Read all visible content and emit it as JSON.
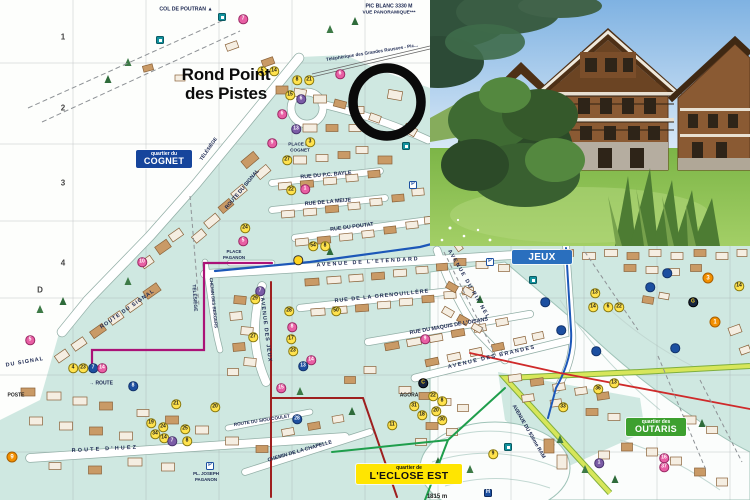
{
  "title": {
    "line1": "Rond Point",
    "line2": "des Pistes"
  },
  "quartiers": {
    "cognet": {
      "small": "quartier du",
      "name": "COGNET",
      "bg": "#16459c",
      "fg": "#ffffff"
    },
    "jeux": {
      "small": "",
      "name": "JEUX",
      "bg": "#2a6fbe",
      "fg": "#ffffff"
    },
    "outaris": {
      "small": "quartier des",
      "name": "OUTARIS",
      "bg": "#3da02f",
      "fg": "#ffffff"
    },
    "eclose": {
      "small": "quartier de",
      "name": "L'ECLOSE EST",
      "bg": "#ffe501",
      "fg": "#111111"
    }
  },
  "annotation": {
    "shape": "circle",
    "x": 387,
    "y": 102,
    "r": 34,
    "color": "#0a0a0a"
  },
  "palette": {
    "zone_teal": "#cfe8e1",
    "badge_yellow": "#ffe24d",
    "badge_pink": "#e85fa4",
    "badge_purple": "#7b5ca6",
    "badge_blue": "#1c4fa0",
    "badge_orange": "#f39000",
    "teal_square": "#12929e",
    "route_blue": "#1c57b8",
    "route_magenta": "#aa1277",
    "route_green": "#1f9e4c",
    "route_red": "#cf2a2a",
    "boundary_dark_red": "#9e1f1f",
    "ram_road": "#d7e65a"
  },
  "map": {
    "grid": [
      {
        "t": "1",
        "x": 63,
        "y": 37
      },
      {
        "t": "2",
        "x": 63,
        "y": 108
      },
      {
        "t": "3",
        "x": 63,
        "y": 183
      },
      {
        "t": "4",
        "x": 63,
        "y": 263
      },
      {
        "t": "D",
        "x": 40,
        "y": 290
      }
    ],
    "labels": [
      {
        "t": "COL DE POUTRAN ▲",
        "x": 186,
        "y": 10,
        "s": 5.2
      },
      {
        "t": "PIC BLANC 3330 M",
        "x": 389,
        "y": 7,
        "s": 5.2
      },
      {
        "t": "VUE PANORAMIQUE***",
        "x": 389,
        "y": 14,
        "s": 4.8
      },
      {
        "t": "Téléphérique des Grandes Rousses - Pic...",
        "x": 372,
        "y": 53,
        "r": -9,
        "s": 4.6
      },
      {
        "t": "PLACE DU",
        "x": 300,
        "y": 145,
        "s": 4.6
      },
      {
        "t": "COGNET",
        "x": 300,
        "y": 151,
        "s": 4.6
      },
      {
        "t": "TÉLÉSIÈGE",
        "x": 210,
        "y": 150,
        "r": -55,
        "s": 4.8
      },
      {
        "t": "ROUTE DU SIGNAL",
        "x": 243,
        "y": 190,
        "r": -50,
        "s": 5.4
      },
      {
        "t": "RUE DU P.C. BAYLE",
        "x": 326,
        "y": 176,
        "r": -5,
        "s": 5.4
      },
      {
        "t": "RUE DE LA MEIJE",
        "x": 328,
        "y": 203,
        "r": -5,
        "s": 5.4
      },
      {
        "t": "RUE DU POUTAT",
        "x": 352,
        "y": 228,
        "r": -7,
        "s": 5.4
      },
      {
        "t": "AVENUE DE L'ETENDARD",
        "x": 368,
        "y": 263,
        "r": -3.5,
        "s": 5.4,
        "ls": 1.8
      },
      {
        "t": "RUE DE LA GRENOUILLÈRE",
        "x": 382,
        "y": 297,
        "r": -6,
        "s": 5.4,
        "ls": 1
      },
      {
        "t": "RUE DU MAQUIS DE L'OISANS",
        "x": 449,
        "y": 327,
        "r": -10,
        "s": 5.4
      },
      {
        "t": "AVENUE DES BRANDES",
        "x": 492,
        "y": 358,
        "r": -13,
        "s": 5.4,
        "ls": 1.5
      },
      {
        "t": "AVENUE DU RIF NEL",
        "x": 468,
        "y": 285,
        "r": 60,
        "s": 5.4,
        "ls": 1.5
      },
      {
        "t": "AVENUE DES JEUX",
        "x": 265,
        "y": 330,
        "r": 83,
        "s": 5.4,
        "ls": 1
      },
      {
        "t": "ROUTE DU SIGNAL",
        "x": 128,
        "y": 310,
        "r": -35,
        "s": 5.4,
        "ls": 1
      },
      {
        "t": "DU SIGNAL",
        "x": 25,
        "y": 363,
        "r": -10,
        "s": 5.4,
        "ls": 1
      },
      {
        "t": "TÉLÉSIÈGE",
        "x": 193,
        "y": 298,
        "r": 86,
        "s": 4.8
      },
      {
        "t": "CHEMIN DES BERGERS",
        "x": 213,
        "y": 303,
        "r": 84,
        "s": 4.4
      },
      {
        "t": "PLACE",
        "x": 234,
        "y": 252,
        "s": 4.4
      },
      {
        "t": "PAGANON",
        "x": 234,
        "y": 258,
        "s": 4.4
      },
      {
        "t": "POSTE",
        "x": 16,
        "y": 396,
        "s": 5,
        "c": "#222222"
      },
      {
        "t": "→  ROUTE",
        "x": 101,
        "y": 384,
        "s": 5
      },
      {
        "t": "ROUTE  D'HUEZ",
        "x": 105,
        "y": 450,
        "r": -3,
        "s": 5.4,
        "ls": 2.2
      },
      {
        "t": "ROUTE DU SIOU COULET",
        "x": 262,
        "y": 421,
        "r": -9,
        "s": 4.6
      },
      {
        "t": "CHEMIN DE LA CHAPELLE",
        "x": 300,
        "y": 452,
        "r": -16,
        "s": 5.2
      },
      {
        "t": "PL. JOSEPH",
        "x": 206,
        "y": 474,
        "s": 4.4
      },
      {
        "t": "PAGANON",
        "x": 206,
        "y": 480,
        "s": 4.4
      },
      {
        "t": "AGORA",
        "x": 409,
        "y": 396,
        "s": 5,
        "c": "#222222"
      },
      {
        "t": "AVENUE DU 93ème RAM",
        "x": 528,
        "y": 432,
        "r": 60,
        "s": 5.2
      },
      {
        "t": "1815 m",
        "x": 437,
        "y": 497,
        "s": 6,
        "c": "#222222"
      }
    ],
    "badges": [
      {
        "n": "7",
        "x": 243,
        "y": 19,
        "c": "p"
      },
      {
        "n": "",
        "x": 222,
        "y": 17,
        "c": "t"
      },
      {
        "n": "",
        "x": 160,
        "y": 40,
        "c": "t"
      },
      {
        "n": "5",
        "x": 262,
        "y": 71,
        "c": "y"
      },
      {
        "n": "14",
        "x": 274,
        "y": 71,
        "c": "y"
      },
      {
        "n": "8",
        "x": 297,
        "y": 80,
        "c": "y"
      },
      {
        "n": "21",
        "x": 309,
        "y": 80,
        "c": "y"
      },
      {
        "n": "6",
        "x": 340,
        "y": 74,
        "c": "p"
      },
      {
        "n": "15",
        "x": 290,
        "y": 95,
        "c": "y"
      },
      {
        "n": "6",
        "x": 301,
        "y": 99,
        "c": "v"
      },
      {
        "n": "6",
        "x": 282,
        "y": 114,
        "c": "p"
      },
      {
        "n": "13",
        "x": 296,
        "y": 129,
        "c": "v"
      },
      {
        "n": "",
        "x": 406,
        "y": 146,
        "c": "t"
      },
      {
        "n": "9",
        "x": 272,
        "y": 143,
        "c": "p"
      },
      {
        "n": "3",
        "x": 310,
        "y": 142,
        "c": "y"
      },
      {
        "n": "27",
        "x": 287,
        "y": 160,
        "c": "y"
      },
      {
        "n": "22",
        "x": 291,
        "y": 190,
        "c": "y"
      },
      {
        "n": "1",
        "x": 305,
        "y": 189,
        "c": "p"
      },
      {
        "n": "P",
        "x": 413,
        "y": 185,
        "c": "P"
      },
      {
        "n": "24",
        "x": 245,
        "y": 228,
        "c": "y"
      },
      {
        "n": "5",
        "x": 243,
        "y": 241,
        "c": "p"
      },
      {
        "n": "54",
        "x": 313,
        "y": 246,
        "c": "y"
      },
      {
        "n": "8",
        "x": 325,
        "y": 246,
        "c": "y"
      },
      {
        "n": "",
        "x": 298,
        "y": 260,
        "c": "g"
      },
      {
        "n": "10",
        "x": 142,
        "y": 262,
        "c": "p"
      },
      {
        "n": "7",
        "x": 260,
        "y": 291,
        "c": "v"
      },
      {
        "n": "29",
        "x": 255,
        "y": 299,
        "c": "y"
      },
      {
        "n": "28",
        "x": 289,
        "y": 311,
        "c": "y"
      },
      {
        "n": "50",
        "x": 336,
        "y": 311,
        "c": "y"
      },
      {
        "n": "8",
        "x": 292,
        "y": 327,
        "c": "p"
      },
      {
        "n": "17",
        "x": 291,
        "y": 339,
        "c": "y"
      },
      {
        "n": "27",
        "x": 253,
        "y": 337,
        "c": "y"
      },
      {
        "n": "23",
        "x": 293,
        "y": 351,
        "c": "y"
      },
      {
        "n": "14",
        "x": 311,
        "y": 360,
        "c": "p"
      },
      {
        "n": "13",
        "x": 303,
        "y": 366,
        "c": "b"
      },
      {
        "n": "15",
        "x": 281,
        "y": 388,
        "c": "p"
      },
      {
        "n": "9",
        "x": 425,
        "y": 339,
        "c": "p"
      },
      {
        "n": "4",
        "x": 73,
        "y": 368,
        "c": "y"
      },
      {
        "n": "23",
        "x": 83,
        "y": 368,
        "c": "y"
      },
      {
        "n": "7",
        "x": 93,
        "y": 368,
        "c": "b"
      },
      {
        "n": "14",
        "x": 102,
        "y": 368,
        "c": "p"
      },
      {
        "n": "5",
        "x": 30,
        "y": 340,
        "c": "p"
      },
      {
        "n": "8",
        "x": 133,
        "y": 386,
        "c": "b"
      },
      {
        "n": "21",
        "x": 176,
        "y": 404,
        "c": "y"
      },
      {
        "n": "20",
        "x": 215,
        "y": 407,
        "c": "y"
      },
      {
        "n": "19",
        "x": 151,
        "y": 423,
        "c": "y"
      },
      {
        "n": "24",
        "x": 163,
        "y": 427,
        "c": "y"
      },
      {
        "n": "25",
        "x": 185,
        "y": 429,
        "c": "y"
      },
      {
        "n": "34",
        "x": 155,
        "y": 434,
        "c": "y"
      },
      {
        "n": "14",
        "x": 164,
        "y": 438,
        "c": "y"
      },
      {
        "n": "7",
        "x": 172,
        "y": 441,
        "c": "v"
      },
      {
        "n": "8",
        "x": 187,
        "y": 441,
        "c": "y"
      },
      {
        "n": "9",
        "x": 12,
        "y": 457,
        "c": "o"
      },
      {
        "n": "P",
        "x": 210,
        "y": 466,
        "c": "P"
      },
      {
        "n": "28",
        "x": 297,
        "y": 419,
        "c": "b"
      },
      {
        "n": "11",
        "x": 392,
        "y": 425,
        "c": "y"
      },
      {
        "n": "22",
        "x": 433,
        "y": 396,
        "c": "y"
      },
      {
        "n": "8",
        "x": 442,
        "y": 401,
        "c": "y"
      },
      {
        "n": "31",
        "x": 414,
        "y": 406,
        "c": "y"
      },
      {
        "n": "20",
        "x": 436,
        "y": 411,
        "c": "y"
      },
      {
        "n": "18",
        "x": 422,
        "y": 415,
        "c": "y"
      },
      {
        "n": "30",
        "x": 442,
        "y": 420,
        "c": "y"
      },
      {
        "n": "C",
        "x": 423,
        "y": 383,
        "c": "d"
      },
      {
        "n": "9",
        "x": 493,
        "y": 454,
        "c": "y"
      },
      {
        "n": "H",
        "x": 488,
        "y": 493,
        "c": "H"
      },
      {
        "n": "",
        "x": 508,
        "y": 447,
        "c": "t"
      },
      {
        "n": "P",
        "x": 490,
        "y": 262,
        "c": "P"
      },
      {
        "n": "",
        "x": 533,
        "y": 280,
        "c": "t"
      },
      {
        "n": "13",
        "x": 595,
        "y": 293,
        "c": "y"
      },
      {
        "n": "14",
        "x": 593,
        "y": 307,
        "c": "y"
      },
      {
        "n": "6",
        "x": 608,
        "y": 307,
        "c": "y"
      },
      {
        "n": "22",
        "x": 619,
        "y": 307,
        "c": "y"
      },
      {
        "n": "14",
        "x": 739,
        "y": 286,
        "c": "y"
      },
      {
        "n": "3",
        "x": 708,
        "y": 278,
        "c": "o"
      },
      {
        "n": "1",
        "x": 715,
        "y": 322,
        "c": "o"
      },
      {
        "n": "G",
        "x": 693,
        "y": 302,
        "c": "d"
      },
      {
        "n": "13",
        "x": 614,
        "y": 383,
        "c": "y"
      },
      {
        "n": "36",
        "x": 598,
        "y": 389,
        "c": "y"
      },
      {
        "n": "33",
        "x": 563,
        "y": 407,
        "c": "y"
      },
      {
        "n": "1",
        "x": 599,
        "y": 463,
        "c": "v"
      },
      {
        "n": "16",
        "x": 664,
        "y": 458,
        "c": "p"
      },
      {
        "n": "37",
        "x": 664,
        "y": 467,
        "c": "p"
      },
      {
        "n": "",
        "x": 650,
        "y": 287,
        "c": "b"
      },
      {
        "n": "",
        "x": 667,
        "y": 273,
        "c": "b"
      },
      {
        "n": "",
        "x": 596,
        "y": 351,
        "c": "b"
      },
      {
        "n": "",
        "x": 675,
        "y": 348,
        "c": "b"
      },
      {
        "n": "",
        "x": 545,
        "y": 302,
        "c": "b"
      },
      {
        "n": "",
        "x": 561,
        "y": 330,
        "c": "b"
      }
    ]
  }
}
